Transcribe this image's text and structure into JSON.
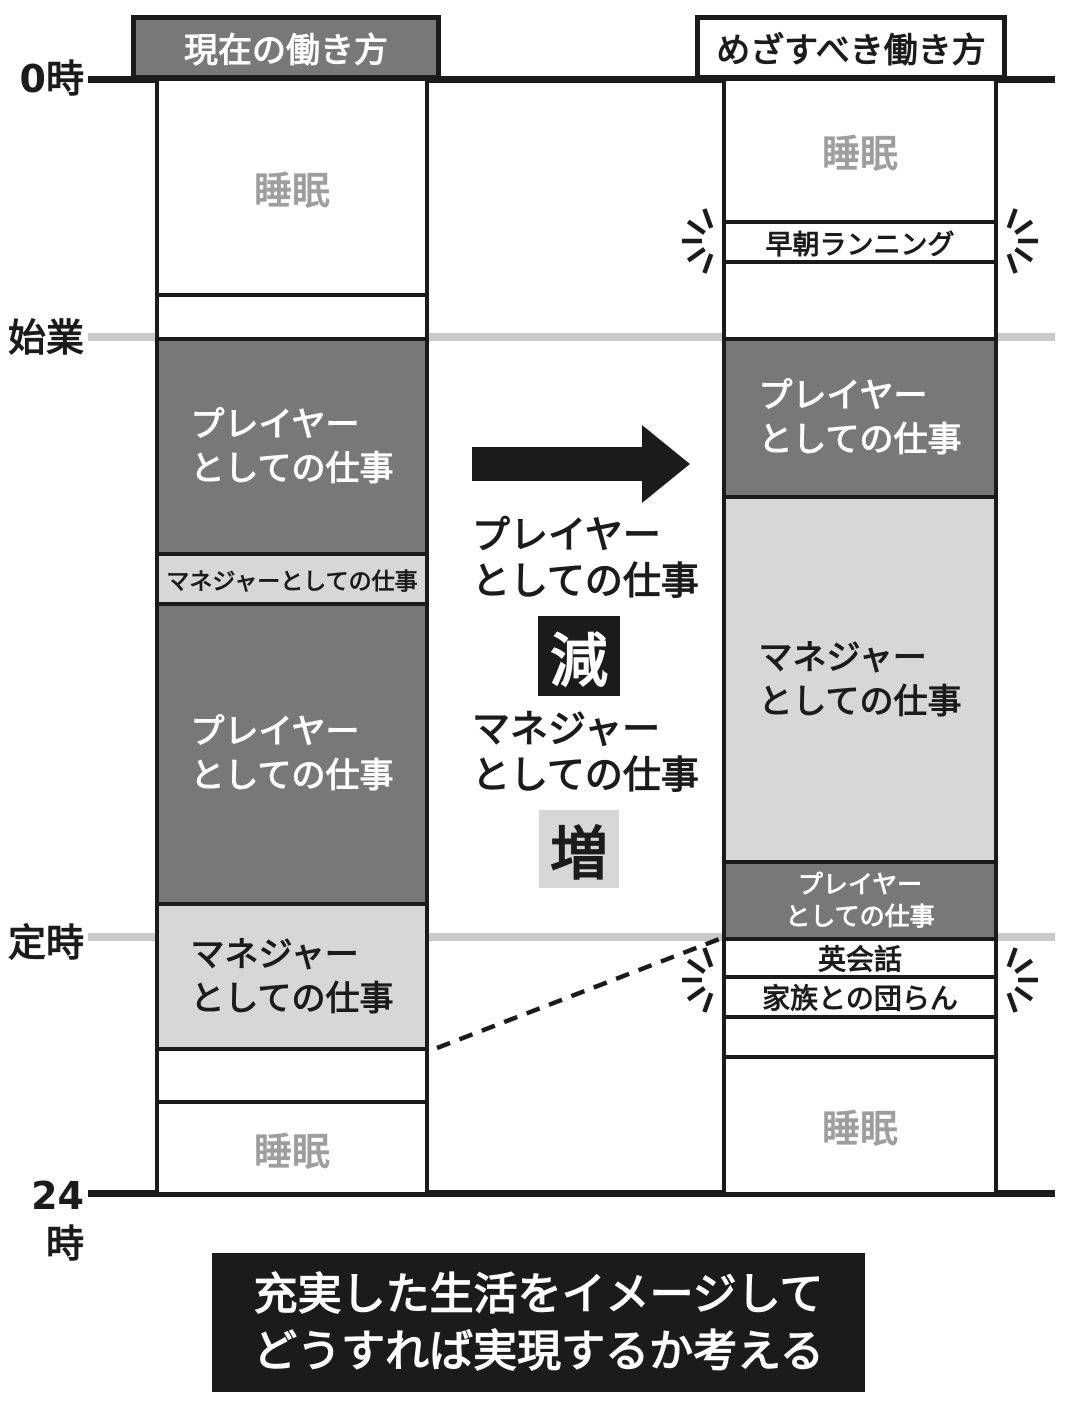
{
  "colors": {
    "dark_gray": "#787878",
    "light_gray": "#d7d7d7",
    "axis_line_gray": "#c9c9c9",
    "sleep_text_gray": "#9e9e9e",
    "ink_black": "#1b1b1b",
    "white": "#ffffff"
  },
  "axis": {
    "t0": "0時",
    "start": "始業",
    "regular_end": "定時",
    "t24": "24時"
  },
  "headers": {
    "current": "現在の働き方",
    "ideal": "めざすべき働き方"
  },
  "current": {
    "sleep_morning": "睡眠",
    "player_1": "プレイヤー\nとしての仕事",
    "manager_mid": "マネジャーとしての仕事",
    "player_2": "プレイヤー\nとしての仕事",
    "manager_evening": "マネジャー\nとしての仕事",
    "sleep_night": "睡眠"
  },
  "ideal": {
    "sleep_morning": "睡眠",
    "morning_run": "早朝ランニング",
    "player_morning": "プレイヤー\nとしての仕事",
    "manager_day": "マネジャー\nとしての仕事",
    "player_late": "プレイヤー\nとしての仕事",
    "english": "英会話",
    "family": "家族との団らん",
    "sleep_night": "睡眠"
  },
  "middle": {
    "player_label": "プレイヤー\nとしての仕事",
    "decrease_badge": "減",
    "manager_label": "マネジャー\nとしての仕事",
    "increase_badge": "増"
  },
  "footer": "充実した生活をイメージして\nどうすれば実現するか考える"
}
